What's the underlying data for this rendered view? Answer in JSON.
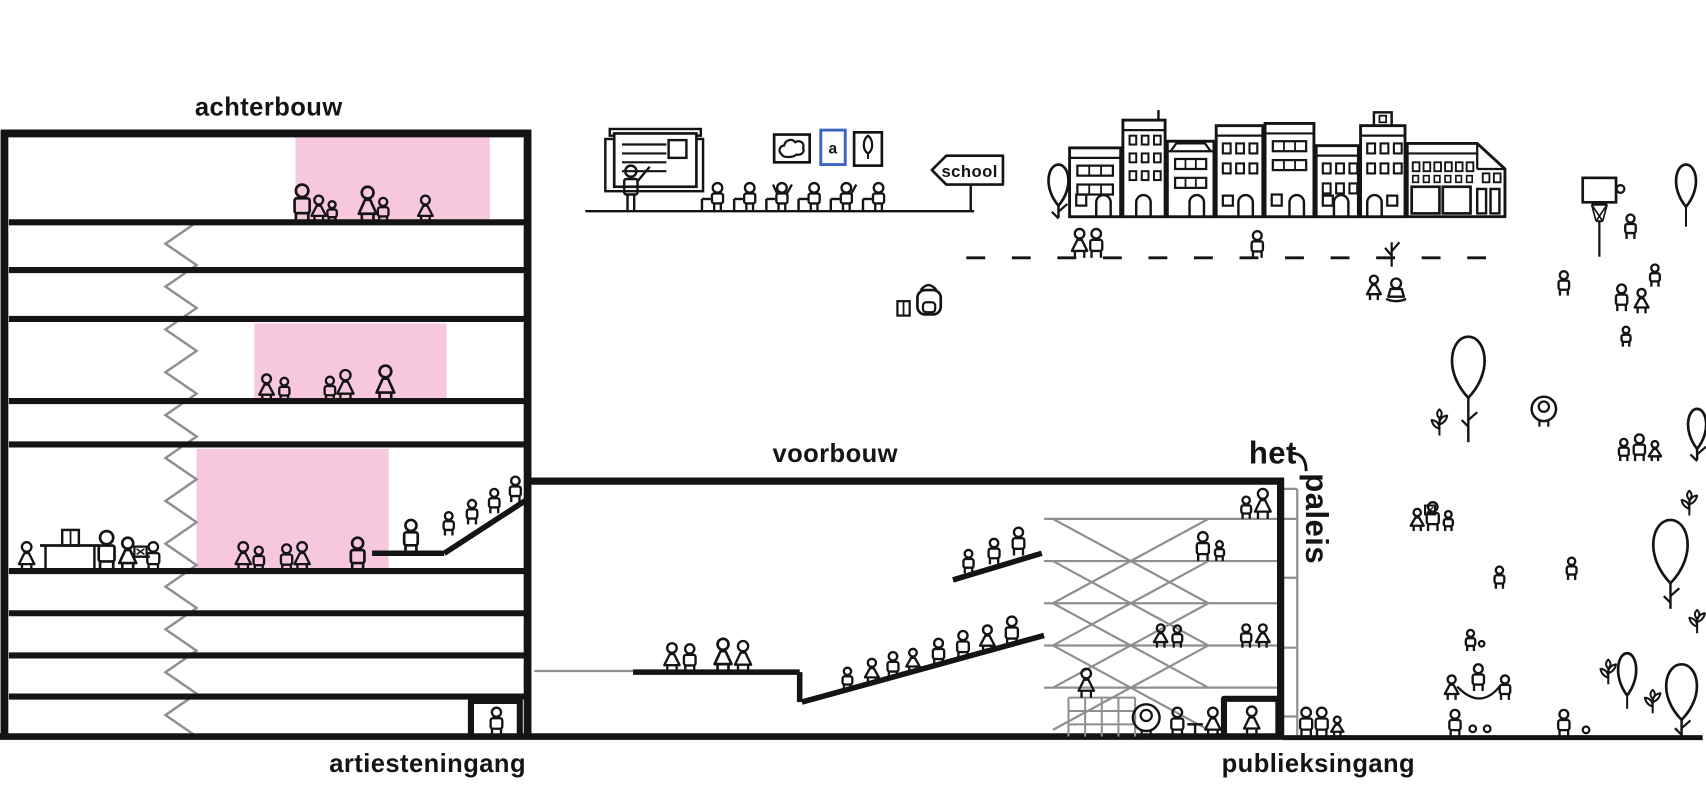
{
  "labels": {
    "achterbouw": "achterbouw",
    "voorbouw": "voorbouw",
    "het": "het",
    "paleis": "paleis",
    "artiesteningang": "artiesteningang",
    "publieksingang": "publieksingang",
    "school_sign": "school",
    "letter_frame": "a"
  },
  "colors": {
    "ink": "#141414",
    "pink": "#f7c7de",
    "gray": "#8f8f8f",
    "blue": "#3b64c6",
    "background": "#ffffff"
  },
  "scene": {
    "canvas": {
      "w": 1536,
      "h": 720
    },
    "achterbouw": {
      "left": 4,
      "right": 475,
      "top": 120,
      "ground": 663,
      "floor_lines_y": [
        200,
        243,
        287,
        361,
        400,
        514,
        552,
        590,
        627
      ],
      "zigzag": {
        "x_right": 177,
        "x_left": 149,
        "top": 200,
        "bottom": 663,
        "steps": 24
      },
      "pink_rooms": [
        {
          "x": 266,
          "y": 123,
          "w": 175,
          "h": 76
        },
        {
          "x": 229,
          "y": 291,
          "w": 173,
          "h": 69
        },
        {
          "x": 177,
          "y": 404,
          "w": 173,
          "h": 109
        }
      ],
      "platform": {
        "flat": [
          335,
          498,
          400,
          498
        ],
        "ramp": [
          400,
          498,
          477,
          448
        ]
      },
      "door": {
        "x1": 424,
        "x2": 468,
        "top": 631
      }
    },
    "voorbouw": {
      "roof": [
        478,
        433,
        1156,
        433
      ],
      "wall_x": 1153,
      "wall_top": 430,
      "ground": 663,
      "gray_left_line": [
        481,
        604,
        570,
        604
      ],
      "gray_floors": [
        [
          940,
          467,
          1151,
          467
        ],
        [
          940,
          505,
          1151,
          505
        ],
        [
          940,
          543,
          1151,
          543
        ],
        [
          940,
          581,
          1151,
          581
        ],
        [
          940,
          619,
          1151,
          619
        ]
      ],
      "braces": [
        [
          948,
          467,
          1088,
          543
        ],
        [
          1088,
          467,
          948,
          543
        ],
        [
          948,
          505,
          1088,
          581
        ],
        [
          1088,
          505,
          948,
          581
        ],
        [
          948,
          543,
          1088,
          619
        ],
        [
          1088,
          543,
          948,
          619
        ],
        [
          948,
          581,
          1088,
          657
        ],
        [
          1088,
          581,
          948,
          657
        ]
      ],
      "gray_back": {
        "x": 1168,
        "top": 440,
        "bottom": 662,
        "rungs_y": [
          440,
          467,
          520,
          583,
          645
        ]
      },
      "platform": [
        570,
        605,
        720,
        605
      ],
      "platform_drop": [
        720,
        605,
        720,
        632
      ],
      "big_ramp": [
        722,
        632,
        940,
        572
      ],
      "short_ramp": [
        858,
        522,
        938,
        498
      ],
      "door": {
        "x1": 1102,
        "x2": 1151,
        "top": 629
      }
    },
    "ground": {
      "main": [
        0,
        663,
        1155,
        663
      ],
      "outdoor": [
        1155,
        664,
        1533,
        664
      ]
    },
    "people": [
      [
        272,
        200,
        34,
        "r"
      ],
      [
        287,
        200,
        24,
        "s"
      ],
      [
        299,
        200,
        19,
        "r"
      ],
      [
        331,
        200,
        32,
        "s"
      ],
      [
        345,
        200,
        22,
        "r"
      ],
      [
        383,
        200,
        24,
        "s"
      ],
      [
        240,
        361,
        24,
        "s"
      ],
      [
        256,
        361,
        21,
        "r"
      ],
      [
        297,
        361,
        22,
        "r"
      ],
      [
        311,
        361,
        28,
        "s"
      ],
      [
        347,
        361,
        32,
        "s"
      ],
      [
        24,
        514,
        26,
        "s"
      ],
      [
        96,
        514,
        36,
        "r"
      ],
      [
        115,
        514,
        30,
        "s"
      ],
      [
        138,
        514,
        26,
        "r"
      ],
      [
        219,
        514,
        26,
        "s"
      ],
      [
        233,
        514,
        22,
        "r"
      ],
      [
        258,
        514,
        24,
        "r"
      ],
      [
        272,
        514,
        26,
        "s"
      ],
      [
        322,
        514,
        30,
        "r"
      ],
      [
        370,
        498,
        30,
        "r"
      ],
      [
        404,
        482,
        21,
        "r"
      ],
      [
        425,
        472,
        22,
        "r"
      ],
      [
        445,
        462,
        22,
        "r"
      ],
      [
        464,
        452,
        23,
        "r"
      ],
      [
        447,
        662,
        25,
        "r"
      ],
      [
        605,
        605,
        26,
        "s"
      ],
      [
        621,
        605,
        25,
        "r"
      ],
      [
        651,
        605,
        30,
        "s"
      ],
      [
        669,
        605,
        28,
        "s"
      ],
      [
        763,
        621,
        20,
        "r"
      ],
      [
        785,
        615,
        22,
        "s"
      ],
      [
        804,
        610,
        23,
        "r"
      ],
      [
        822,
        605,
        21,
        "s"
      ],
      [
        845,
        599,
        24,
        "r"
      ],
      [
        867,
        593,
        25,
        "r"
      ],
      [
        889,
        587,
        24,
        "s"
      ],
      [
        911,
        581,
        26,
        "r"
      ],
      [
        872,
        516,
        21,
        "r"
      ],
      [
        895,
        508,
        23,
        "r"
      ],
      [
        917,
        500,
        25,
        "r"
      ],
      [
        1122,
        467,
        20,
        "r"
      ],
      [
        1137,
        467,
        27,
        "s"
      ],
      [
        1083,
        505,
        26,
        "r"
      ],
      [
        1098,
        505,
        18,
        "r"
      ],
      [
        1045,
        583,
        21,
        "s"
      ],
      [
        1060,
        583,
        20,
        "r"
      ],
      [
        1122,
        583,
        21,
        "r"
      ],
      [
        1137,
        583,
        21,
        "s"
      ],
      [
        978,
        628,
        26,
        "s"
      ],
      [
        1060,
        663,
        26,
        "r"
      ],
      [
        1092,
        663,
        26,
        "s"
      ],
      [
        1127,
        662,
        26,
        "s"
      ],
      [
        1176,
        663,
        26,
        "r"
      ],
      [
        1190,
        663,
        26,
        "r"
      ],
      [
        1204,
        663,
        18,
        "s"
      ],
      [
        1310,
        663,
        24,
        "r"
      ],
      [
        1408,
        663,
        24,
        "r"
      ],
      [
        1468,
        215,
        22,
        "r"
      ],
      [
        972,
        232,
        26,
        "s"
      ],
      [
        987,
        232,
        26,
        "r"
      ],
      [
        1132,
        232,
        24,
        "r"
      ],
      [
        1237,
        270,
        22,
        "s"
      ],
      [
        1408,
        266,
        22,
        "r"
      ],
      [
        1460,
        280,
        24,
        "r"
      ],
      [
        1478,
        282,
        22,
        "s"
      ],
      [
        1490,
        258,
        20,
        "r"
      ],
      [
        1464,
        312,
        18,
        "r"
      ],
      [
        1276,
        478,
        20,
        "s"
      ],
      [
        1290,
        478,
        26,
        "r"
      ],
      [
        1304,
        478,
        18,
        "r"
      ],
      [
        1350,
        530,
        20,
        "r"
      ],
      [
        1415,
        522,
        20,
        "r"
      ],
      [
        1324,
        586,
        19,
        "r"
      ],
      [
        1307,
        630,
        22,
        "s"
      ],
      [
        1331,
        622,
        24,
        "r"
      ],
      [
        1355,
        630,
        22,
        "r"
      ],
      [
        1462,
        415,
        20,
        "r"
      ],
      [
        1476,
        415,
        24,
        "r"
      ],
      [
        1490,
        415,
        18,
        "s"
      ]
    ],
    "props": [
      {
        "t": "gline",
        "x1": 527,
        "y1": 190,
        "x2": 877,
        "y2": 190
      },
      {
        "t": "dashes",
        "x1": 870,
        "x2": 1350,
        "y": 232
      },
      {
        "t": "board",
        "x": 545,
        "y": 116
      },
      {
        "t": "desks",
        "x": 636,
        "y": 190,
        "n": 6
      },
      {
        "t": "frames",
        "x": 697,
        "y": 117
      },
      {
        "t": "sign",
        "x": 839,
        "y": 140
      },
      {
        "t": "backpack",
        "x": 822,
        "y": 258
      },
      {
        "t": "twig",
        "x": 1253,
        "y": 240
      },
      {
        "t": "sitkid",
        "x": 1257,
        "y": 270
      },
      {
        "t": "balloontree",
        "x": 953,
        "top": 148,
        "w": 11,
        "h": 37,
        "stem": 196
      },
      {
        "t": "balloon",
        "x": 1518,
        "top": 148,
        "w": 11,
        "h": 38,
        "string": 18
      },
      {
        "t": "basketball",
        "x": 1425,
        "y": 160
      },
      {
        "t": "balloontree",
        "x": 1322,
        "top": 303,
        "w": 18,
        "h": 55,
        "stem": 398
      },
      {
        "t": "flower",
        "x": 1296,
        "y": 392,
        "s": 24
      },
      {
        "t": "hoodkid",
        "x": 1390,
        "y": 384,
        "r": 11
      },
      {
        "t": "balloontree",
        "x": 1528,
        "top": 368,
        "w": 10,
        "h": 36,
        "stem": 414
      },
      {
        "t": "flower",
        "x": 1521,
        "y": 464,
        "s": 22
      },
      {
        "t": "balloontree",
        "x": 1504,
        "top": 468,
        "w": 19,
        "h": 57,
        "stem": 548
      },
      {
        "t": "flower",
        "x": 1448,
        "y": 616,
        "s": 22
      },
      {
        "t": "flower",
        "x": 1488,
        "y": 642,
        "s": 20
      },
      {
        "t": "flower",
        "x": 1528,
        "y": 570,
        "s": 20
      },
      {
        "t": "balloon",
        "x": 1465,
        "top": 588,
        "w": 10,
        "h": 38,
        "string": 12
      },
      {
        "t": "balloontree",
        "x": 1514,
        "top": 598,
        "w": 17,
        "h": 50,
        "stem": 663
      },
      {
        "t": "ball",
        "x": 1326,
        "y": 659,
        "r": 3
      },
      {
        "t": "ball",
        "x": 1339,
        "y": 659,
        "r": 3
      },
      {
        "t": "ball",
        "x": 1428,
        "y": 660,
        "r": 3
      },
      {
        "t": "ball",
        "x": 1334,
        "y": 582,
        "r": 2.5
      },
      {
        "t": "rope",
        "d": "M1312,618 Q1333,640 1351,617"
      },
      {
        "t": "stool",
        "x": 1076,
        "y": 663
      },
      {
        "t": "table",
        "x": 36,
        "y": 491
      },
      {
        "t": "laptop",
        "x": 121,
        "y": 501
      },
      {
        "t": "screen",
        "x": 1283,
        "y": 463
      },
      {
        "t": "grid",
        "x": 962,
        "y": 628,
        "x2": 1022,
        "y2": 663
      },
      {
        "t": "hoodkid",
        "x": 1032,
        "y": 663,
        "r": 12
      }
    ],
    "houses": {
      "baseline": 195,
      "items": [
        {
          "x": 963,
          "w": 46,
          "h": 62,
          "kind": "a"
        },
        {
          "x": 1011,
          "w": 38,
          "h": 87,
          "kind": "b"
        },
        {
          "x": 1051,
          "w": 42,
          "h": 68,
          "kind": "c"
        },
        {
          "x": 1095,
          "w": 42,
          "h": 82,
          "kind": "d"
        },
        {
          "x": 1139,
          "w": 44,
          "h": 84,
          "kind": "a"
        },
        {
          "x": 1185,
          "w": 38,
          "h": 64,
          "kind": "d"
        },
        {
          "x": 1225,
          "w": 40,
          "h": 82,
          "kind": "e"
        },
        {
          "x": 1267,
          "w": 88,
          "h": 66,
          "kind": "shop"
        }
      ]
    }
  }
}
